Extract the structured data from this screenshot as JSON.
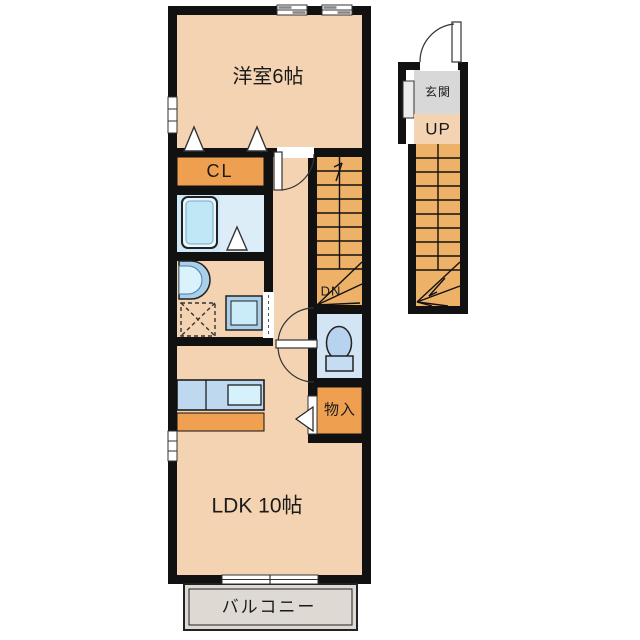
{
  "floorplan": {
    "rooms": {
      "western_room": {
        "label": "洋室6帖"
      },
      "closet": {
        "label": "CL"
      },
      "ldk": {
        "label": "LDK 10帖"
      },
      "balcony": {
        "label": "バルコニー"
      },
      "entrance": {
        "label": "玄関"
      },
      "storage": {
        "label": "物入"
      },
      "stairs_up": {
        "label": "UP"
      },
      "stairs_down": {
        "label": "DN"
      }
    },
    "palette": {
      "wall": "#111111",
      "room_floor": "#f4d3b2",
      "closet_fill": "#ef9f50",
      "stair_fill": "#edb168",
      "entrance_floor": "#d8d8d8",
      "bath_floor_left": "#cfe8f6",
      "bath_floor_right": "#dcedf8",
      "toilet_floor": "#d3e4f4",
      "fixture_blue": "#bdd8ef",
      "fixture_light": "#d5f1fb",
      "balcony_fill": "#ded9d2"
    }
  }
}
